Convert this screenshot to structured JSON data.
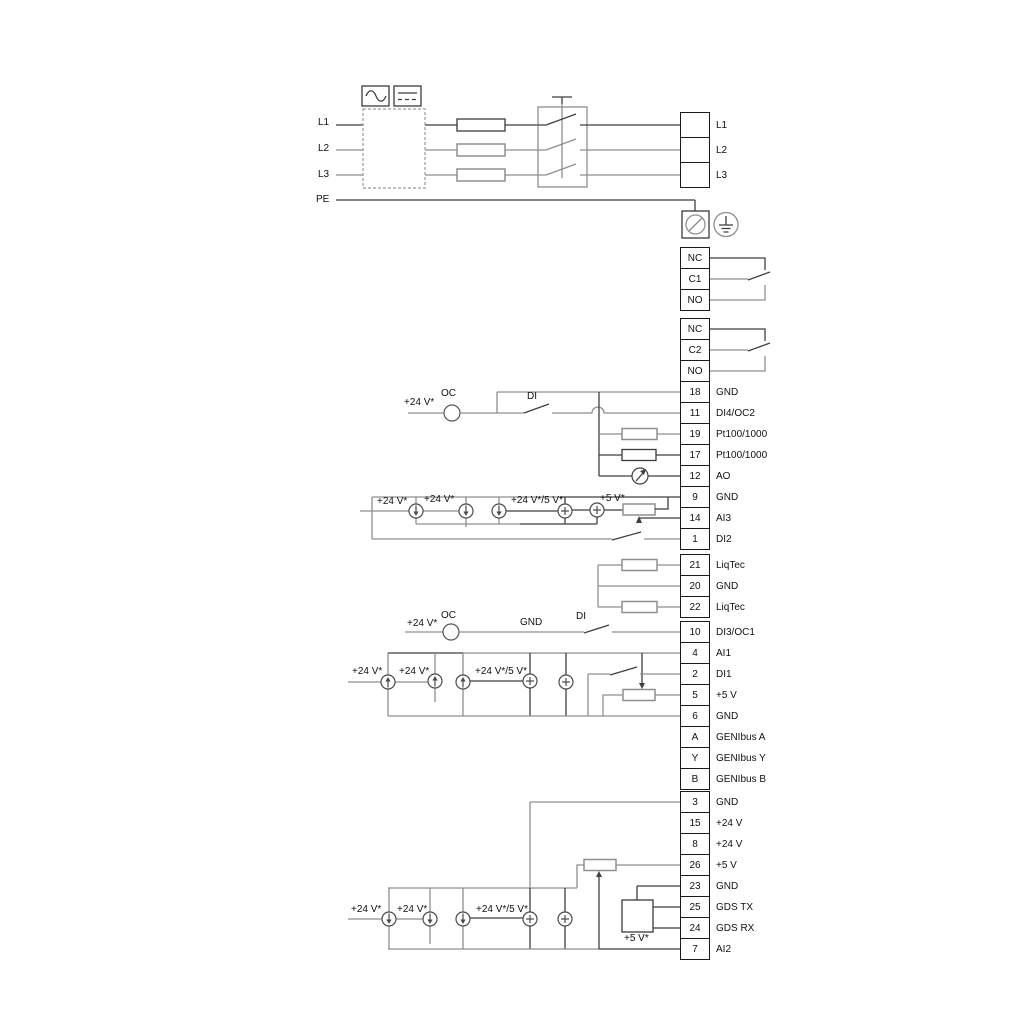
{
  "colors": {
    "wire_gray": "#8f8f8f",
    "wire_dark": "#3f3f3f",
    "text": "#111111",
    "background": "#ffffff"
  },
  "terminal_strips": [
    {
      "name": "mains-output",
      "x": 680,
      "y": 112,
      "cell_h": 24,
      "cells": [
        {
          "num": "",
          "label": "L1"
        },
        {
          "num": "",
          "label": "L2"
        },
        {
          "num": "",
          "label": "L3"
        }
      ]
    },
    {
      "name": "relay-1",
      "x": 680,
      "y": 247,
      "cell_h": 20,
      "cells": [
        {
          "num": "NC",
          "label": ""
        },
        {
          "num": "C1",
          "label": ""
        },
        {
          "num": "NO",
          "label": ""
        }
      ]
    },
    {
      "name": "relay-2",
      "x": 680,
      "y": 318,
      "cell_h": 20,
      "cells": [
        {
          "num": "NC",
          "label": ""
        },
        {
          "num": "C2",
          "label": ""
        },
        {
          "num": "NO",
          "label": ""
        }
      ]
    },
    {
      "name": "io-upper",
      "x": 680,
      "y": 381,
      "cell_h": 20,
      "cells": [
        {
          "num": "18",
          "label": "GND"
        },
        {
          "num": "11",
          "label": "DI4/OC2"
        },
        {
          "num": "19",
          "label": "Pt100/1000"
        },
        {
          "num": "17",
          "label": "Pt100/1000"
        },
        {
          "num": "12",
          "label": "AO"
        },
        {
          "num": "9",
          "label": "GND"
        },
        {
          "num": "14",
          "label": "AI3"
        },
        {
          "num": "1",
          "label": "DI2"
        }
      ]
    },
    {
      "name": "liqtec",
      "x": 680,
      "y": 554,
      "cell_h": 20,
      "cells": [
        {
          "num": "21",
          "label": "LiqTec"
        },
        {
          "num": "20",
          "label": "GND"
        },
        {
          "num": "22",
          "label": "LiqTec"
        }
      ]
    },
    {
      "name": "io-middle",
      "x": 680,
      "y": 621,
      "cell_h": 20,
      "cells": [
        {
          "num": "10",
          "label": "DI3/OC1"
        },
        {
          "num": "4",
          "label": "AI1"
        },
        {
          "num": "2",
          "label": "DI1"
        },
        {
          "num": "5",
          "label": "+5 V"
        },
        {
          "num": "6",
          "label": "GND"
        },
        {
          "num": "A",
          "label": "GENIbus A"
        },
        {
          "num": "Y",
          "label": "GENIbus Y"
        },
        {
          "num": "B",
          "label": "GENIbus B"
        }
      ]
    },
    {
      "name": "io-lower",
      "x": 680,
      "y": 791,
      "cell_h": 20,
      "cells": [
        {
          "num": "3",
          "label": "GND"
        },
        {
          "num": "15",
          "label": "+24 V"
        },
        {
          "num": "8",
          "label": "+24 V"
        },
        {
          "num": "26",
          "label": "+5 V"
        },
        {
          "num": "23",
          "label": "GND"
        },
        {
          "num": "25",
          "label": "GDS TX"
        },
        {
          "num": "24",
          "label": "GDS RX"
        },
        {
          "num": "7",
          "label": "AI2"
        }
      ]
    }
  ],
  "floating_labels": [
    {
      "name": "label-l1-input",
      "text": "L1",
      "x": 318,
      "y": 117
    },
    {
      "name": "label-l2-input",
      "text": "L2",
      "x": 318,
      "y": 143
    },
    {
      "name": "label-l3-input",
      "text": "L3",
      "x": 318,
      "y": 169
    },
    {
      "name": "label-pe-input",
      "text": "PE",
      "x": 316,
      "y": 194
    },
    {
      "name": "label-24v-oc2",
      "text": "+24 V*",
      "x": 404,
      "y": 397
    },
    {
      "name": "label-oc2",
      "text": "OC",
      "x": 441,
      "y": 388
    },
    {
      "name": "label-di4",
      "text": "DI",
      "x": 527,
      "y": 391
    },
    {
      "name": "label-24v-ai3-1",
      "text": "+24 V*",
      "x": 377,
      "y": 496
    },
    {
      "name": "label-24v-ai3-2",
      "text": "+24 V*",
      "x": 424,
      "y": 494
    },
    {
      "name": "label-24v5v-ai3",
      "text": "+24 V*/5 V*",
      "x": 511,
      "y": 495
    },
    {
      "name": "label-5v-ai3",
      "text": "+5 V*",
      "x": 600,
      "y": 493
    },
    {
      "name": "label-24v-oc1",
      "text": "+24 V*",
      "x": 407,
      "y": 618
    },
    {
      "name": "label-oc1",
      "text": "OC",
      "x": 441,
      "y": 610
    },
    {
      "name": "label-gnd-di3",
      "text": "GND",
      "x": 520,
      "y": 617
    },
    {
      "name": "label-di3",
      "text": "DI",
      "x": 576,
      "y": 611
    },
    {
      "name": "label-24v-ai1-1",
      "text": "+24 V*",
      "x": 352,
      "y": 666
    },
    {
      "name": "label-24v-ai1-2",
      "text": "+24 V*",
      "x": 399,
      "y": 666
    },
    {
      "name": "label-24v5v-ai1",
      "text": "+24 V*/5 V*",
      "x": 475,
      "y": 666
    },
    {
      "name": "label-24v-ai2-1",
      "text": "+24 V*",
      "x": 351,
      "y": 904
    },
    {
      "name": "label-24v-ai2-2",
      "text": "+24 V*",
      "x": 397,
      "y": 904
    },
    {
      "name": "label-24v5v-ai2",
      "text": "+24 V*/5 V*",
      "x": 476,
      "y": 904
    },
    {
      "name": "label-5v-gds",
      "text": "+5 V*",
      "x": 624,
      "y": 933
    }
  ]
}
